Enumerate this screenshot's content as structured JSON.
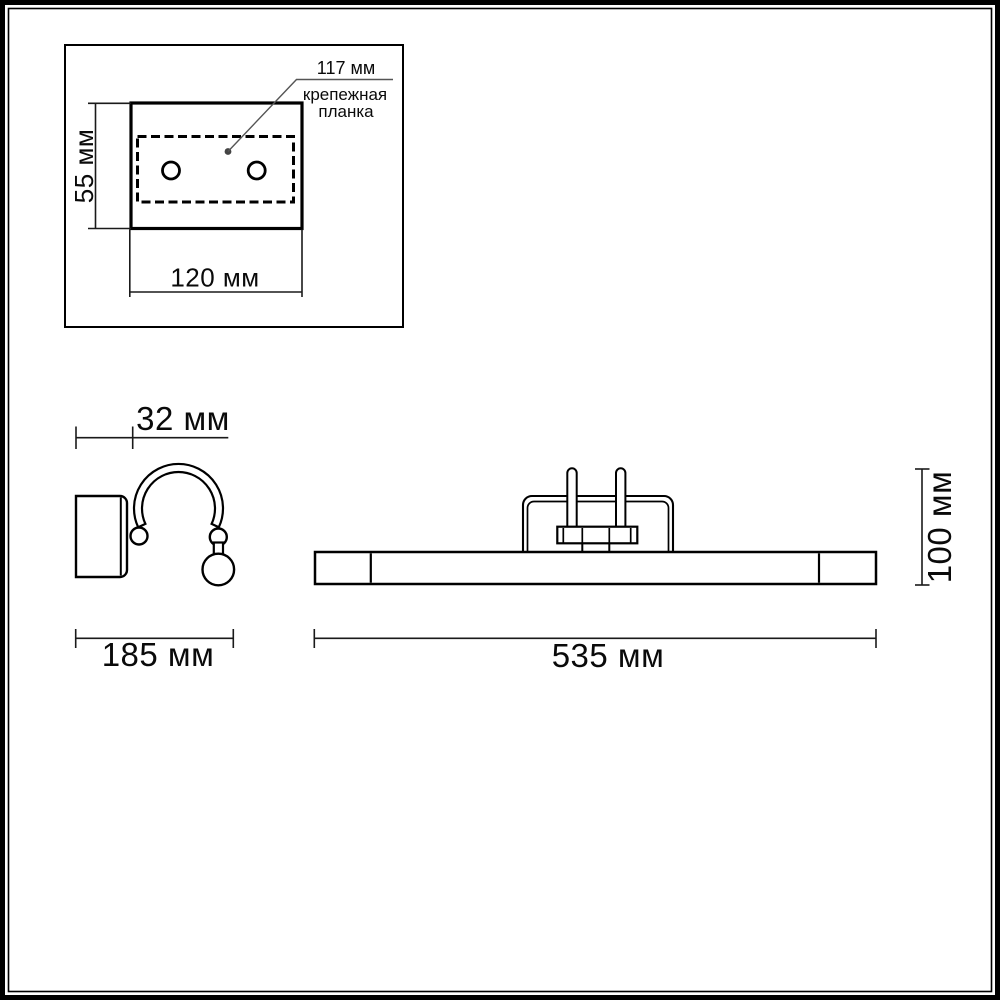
{
  "drawing": {
    "type": "technical-dimension-drawing",
    "views": [
      "mounting-plate-inset",
      "side-view",
      "front-view"
    ]
  },
  "inset": {
    "callout_value": "117 мм",
    "callout_label_line1": "крепежная",
    "callout_label_line2": "планка",
    "height_dim": "55 мм",
    "width_dim": "120 мм",
    "hole_count": 2
  },
  "side_view": {
    "depth_dim": "32 мм",
    "width_dim": "185 мм"
  },
  "front_view": {
    "width_dim": "535 мм",
    "height_dim": "100 мм"
  },
  "colors": {
    "line": "#000000",
    "dim_line": "#1a1a1a",
    "leader_line": "#555555",
    "text": "#0a0a0a",
    "background": "#ffffff"
  }
}
